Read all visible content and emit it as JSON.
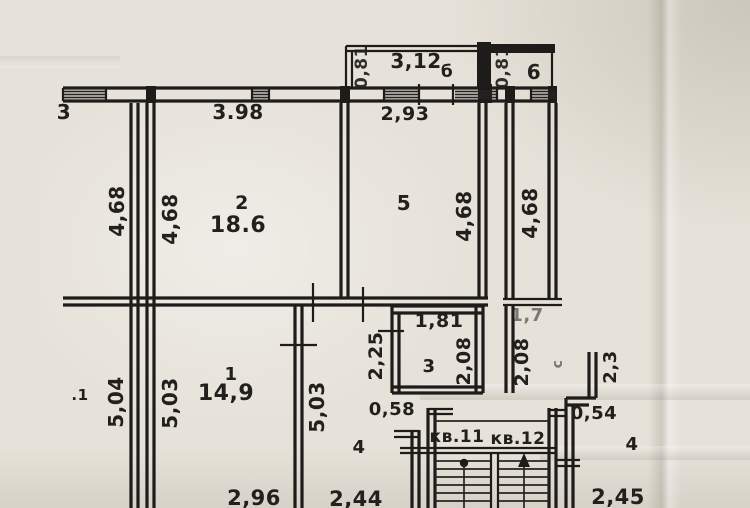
{
  "plan": {
    "balconies": {
      "left": {
        "label": "б",
        "width": "3,12",
        "depth": "0,81"
      },
      "right": {
        "label": "6",
        "depth": "0,81"
      }
    },
    "rooms": {
      "room1": {
        "number": "1",
        "area": "14,9",
        "height": "5,03",
        "width": "2,96"
      },
      "room2": {
        "number": "2",
        "area": "18.6",
        "width": "3.98",
        "height": "4,68"
      },
      "room3": {
        "number": "3",
        "width": "1,81",
        "height": "2,08"
      },
      "room4": {
        "number": "4",
        "width": "2,44"
      },
      "room5": {
        "number": "5",
        "width": "2,93",
        "height": "4,68"
      },
      "bathroom": {
        "label": "с",
        "width": "1,7",
        "height": "2,08",
        "niche_depth": "2,3"
      },
      "neighbor_room": {
        "number": "4",
        "width": "2,45",
        "height": "4,68"
      }
    },
    "corridor": {
      "width": "2,25",
      "height": "5,03",
      "wall_segment": "0,58"
    },
    "stairwell": {
      "apartment_left": "кв.11",
      "apartment_right": "кв.12",
      "wall_segment": "0,54"
    },
    "edge_labels": {
      "top_left": "3",
      "mid_left": ".1",
      "outer_height_top": "4,68",
      "outer_height_bottom": "5,04"
    }
  }
}
